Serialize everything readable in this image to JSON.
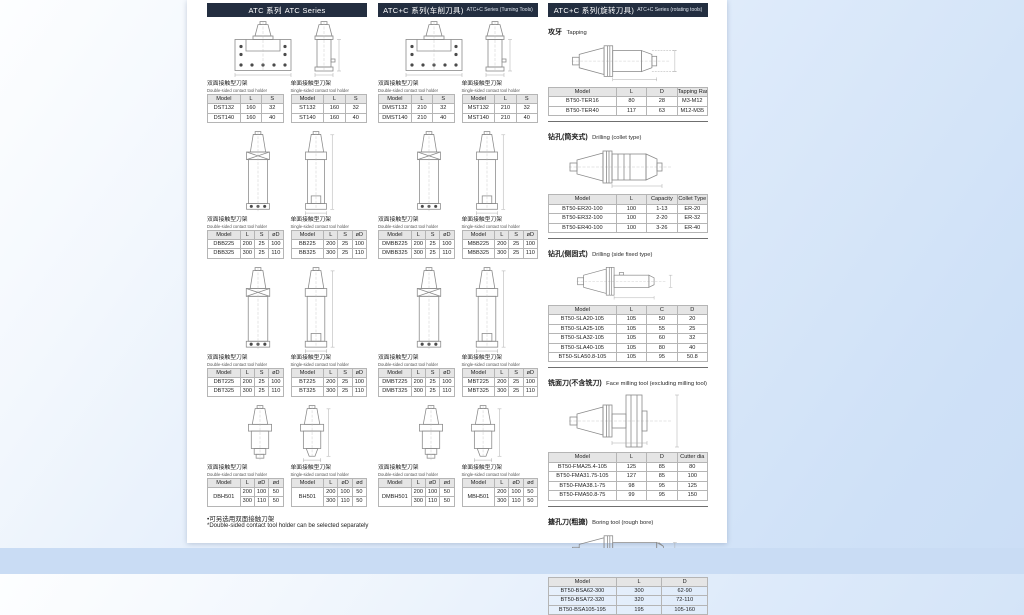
{
  "shared": {
    "double_label_cn": "双面接触型刀架",
    "double_label_en": "Double-sided contact tool holder",
    "single_label_cn": "单面接触型刀架",
    "single_label_en": "Single-sided contact tool holder"
  },
  "colors": {
    "header_bar": "#232e40",
    "table_header_bg": "#e5e5e5",
    "page_bg": "#ffffff",
    "canvas_bg": "#cfe1f7"
  },
  "col1": {
    "header_cn": "ATC 系列",
    "header_en": "ATC Series",
    "g1d": {
      "headers": [
        "Model",
        "L",
        "S"
      ],
      "rows": [
        [
          "DST132",
          "160",
          "32"
        ],
        [
          "DST140",
          "160",
          "40"
        ]
      ]
    },
    "g1s": {
      "headers": [
        "Model",
        "L",
        "S"
      ],
      "rows": [
        [
          "ST132",
          "160",
          "32"
        ],
        [
          "ST140",
          "160",
          "40"
        ]
      ]
    },
    "g2d": {
      "headers": [
        "Model",
        "L",
        "S",
        "øD"
      ],
      "rows": [
        [
          "DBB225",
          "200",
          "25",
          "100"
        ],
        [
          "DBB325",
          "300",
          "25",
          "110"
        ]
      ]
    },
    "g2s": {
      "headers": [
        "Model",
        "L",
        "S",
        "øD"
      ],
      "rows": [
        [
          "BB225",
          "200",
          "25",
          "100"
        ],
        [
          "BB325",
          "300",
          "25",
          "110"
        ]
      ]
    },
    "g3d": {
      "headers": [
        "Model",
        "L",
        "S",
        "øD"
      ],
      "rows": [
        [
          "DBT225",
          "200",
          "25",
          "100"
        ],
        [
          "DBT325",
          "300",
          "25",
          "110"
        ]
      ]
    },
    "g3s": {
      "headers": [
        "Model",
        "L",
        "S",
        "øD"
      ],
      "rows": [
        [
          "BT225",
          "200",
          "25",
          "100"
        ],
        [
          "BT325",
          "300",
          "25",
          "110"
        ]
      ]
    },
    "g4d": {
      "headers": [
        "Model",
        "L",
        "øD",
        "ød"
      ],
      "rows": [
        [
          {
            "v": "DBH501",
            "rs": 2
          },
          "200",
          "100",
          "50"
        ],
        [
          null,
          "300",
          "110",
          "50"
        ]
      ]
    },
    "g4s": {
      "headers": [
        "Model",
        "L",
        "øD",
        "ød"
      ],
      "rows": [
        [
          {
            "v": "BH501",
            "rs": 2
          },
          "200",
          "100",
          "50"
        ],
        [
          null,
          "300",
          "110",
          "50"
        ]
      ]
    },
    "note_cn": "•可另选用双面接触刀架",
    "note_en": "*Double-sided contact tool holder can be selected separately"
  },
  "col2": {
    "header_cn": "ATC+C 系列(车削刀具)",
    "header_en": "ATC+C Series (Turning Tools)",
    "g1d": {
      "headers": [
        "Model",
        "L",
        "S"
      ],
      "rows": [
        [
          "DMST132",
          "210",
          "32"
        ],
        [
          "DMST140",
          "210",
          "40"
        ]
      ]
    },
    "g1s": {
      "headers": [
        "Model",
        "L",
        "S"
      ],
      "rows": [
        [
          "MST132",
          "210",
          "32"
        ],
        [
          "MST140",
          "210",
          "40"
        ]
      ]
    },
    "g2d": {
      "headers": [
        "Model",
        "L",
        "S",
        "øD"
      ],
      "rows": [
        [
          "DMBB225",
          "200",
          "25",
          "100"
        ],
        [
          "DMBB325",
          "300",
          "25",
          "110"
        ]
      ]
    },
    "g2s": {
      "headers": [
        "Model",
        "L",
        "S",
        "øD"
      ],
      "rows": [
        [
          "MBB225",
          "200",
          "25",
          "100"
        ],
        [
          "MBB325",
          "300",
          "25",
          "110"
        ]
      ]
    },
    "g3d": {
      "headers": [
        "Model",
        "L",
        "S",
        "øD"
      ],
      "rows": [
        [
          "DMBT225",
          "200",
          "25",
          "100"
        ],
        [
          "DMBT325",
          "300",
          "25",
          "110"
        ]
      ]
    },
    "g3s": {
      "headers": [
        "Model",
        "L",
        "S",
        "øD"
      ],
      "rows": [
        [
          "MBT225",
          "200",
          "25",
          "100"
        ],
        [
          "MBT325",
          "300",
          "25",
          "110"
        ]
      ]
    },
    "g4d": {
      "headers": [
        "Model",
        "L",
        "øD",
        "ød"
      ],
      "rows": [
        [
          {
            "v": "DMBH501",
            "rs": 2
          },
          "200",
          "100",
          "50"
        ],
        [
          null,
          "300",
          "110",
          "50"
        ]
      ]
    },
    "g4s": {
      "headers": [
        "Model",
        "L",
        "øD",
        "ød"
      ],
      "rows": [
        [
          {
            "v": "MBH501",
            "rs": 2
          },
          "200",
          "100",
          "50"
        ],
        [
          null,
          "300",
          "110",
          "50"
        ]
      ]
    }
  },
  "col3": {
    "header_cn": "ATC+C 系列(旋转刀具)",
    "header_en": "ATC+C Series (rotating tools)",
    "s1": {
      "title_cn": "攻牙",
      "title_en": "Tapping",
      "table": {
        "headers": [
          "Model",
          "L",
          "D",
          "Tapping Range"
        ],
        "rows": [
          [
            "BT50-TER16",
            "80",
            "28",
            "M3-M12"
          ],
          [
            "BT50-TER40",
            "117",
            "63",
            "M12-M35"
          ]
        ]
      }
    },
    "s2": {
      "title_cn": "钻孔(筒夹式)",
      "title_en": "Drilling (collet type)",
      "table": {
        "headers": [
          "Model",
          "L",
          "Capacity",
          "Collet Type"
        ],
        "rows": [
          [
            "BT50-ER20-100",
            "100",
            "1-13",
            "ER-20"
          ],
          [
            "BT50-ER32-100",
            "100",
            "2-20",
            "ER-32"
          ],
          [
            "BT50-ER40-100",
            "100",
            "3-26",
            "ER-40"
          ]
        ]
      }
    },
    "s3": {
      "title_cn": "钻孔(侧固式)",
      "title_en": "Drilling (side fixed type)",
      "table": {
        "headers": [
          "Model",
          "L",
          "C",
          "D"
        ],
        "rows": [
          [
            "BT50-SLA20-105",
            "105",
            "50",
            "20"
          ],
          [
            "BT50-SLA25-105",
            "105",
            "55",
            "25"
          ],
          [
            "BT50-SLA32-105",
            "105",
            "60",
            "32"
          ],
          [
            "BT50-SLA40-105",
            "105",
            "80",
            "40"
          ],
          [
            "BT50-SLA50.8-105",
            "105",
            "95",
            "50.8"
          ]
        ]
      }
    },
    "s4": {
      "title_cn": "铣面刀(不含铣刀)",
      "title_en": "Face milling tool (excluding milling tool)",
      "table": {
        "headers": [
          "Model",
          "L",
          "D",
          "Cutter dia"
        ],
        "rows": [
          [
            "BT50-FMA25.4-105",
            "125",
            "85",
            "80"
          ],
          [
            "BT50-FMA31.75-105",
            "127",
            "85",
            "100"
          ],
          [
            "BT50-FMA38.1-75",
            "98",
            "95",
            "125"
          ],
          [
            "BT50-FMA50.8-75",
            "99",
            "95",
            "150"
          ]
        ]
      }
    },
    "s5": {
      "title_cn": "搪孔刀(粗搪)",
      "title_en": "Boring tool (rough bore)",
      "table": {
        "headers": [
          "Model",
          "L",
          "D"
        ],
        "rows": [
          [
            "BT50-BSA62-300",
            "300",
            "62-90"
          ],
          [
            "BT50-BSA72-320",
            "320",
            "72-110"
          ],
          [
            "BT50-BSA105-195",
            "195",
            "105-160"
          ]
        ]
      }
    }
  }
}
